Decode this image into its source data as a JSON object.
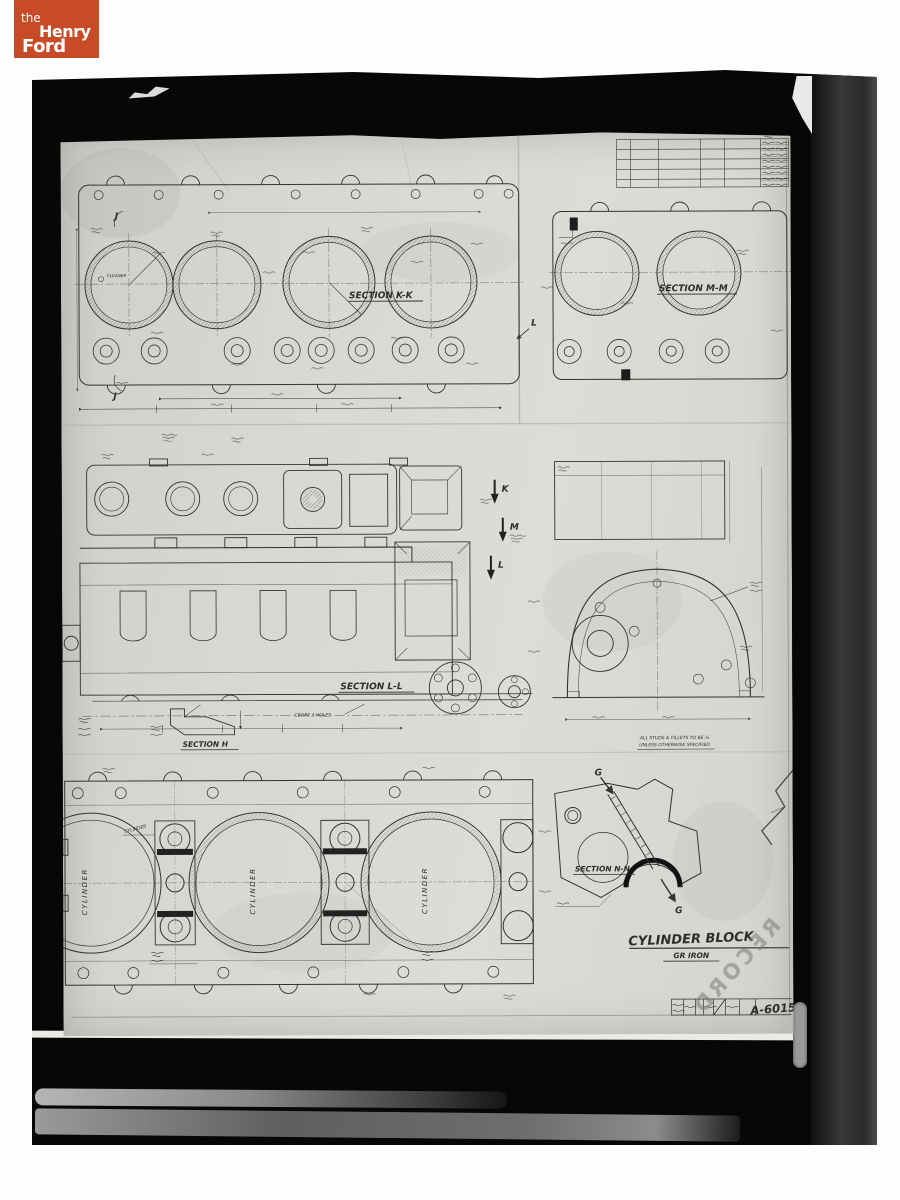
{
  "logo": {
    "line1": "the",
    "line2": "Henry",
    "line3": "Ford",
    "bg_color": "#c84b27"
  },
  "watermark": {
    "text": "RECORD"
  },
  "title_block": {
    "part_name": "CYLINDER BLOCK",
    "material": "GR IRON",
    "drawing_number": "A-6015"
  },
  "section_labels": {
    "kk": "SECTION K-K",
    "mm": "SECTION M-M",
    "ll": "SECTION L-L",
    "h": "SECTION H",
    "nn": "SECTION N-N"
  },
  "view_letters": {
    "j": "J",
    "k": "K",
    "l": "L",
    "m": "M",
    "g": "G"
  },
  "annotations": {
    "cleaner": "CLEANER",
    "cbore_note": "CBORE 3 HOLES",
    "studs_note_line1": "ALL STUDS & FILLETS TO BE ¼",
    "studs_note_line2": "UNLESS OTHERWISE SPECIFIED",
    "cylinder_label": "CYLINDER"
  },
  "colors": {
    "paper": "#d8d7d2",
    "ink": "#2e2e2e",
    "backdrop": "#070707"
  }
}
